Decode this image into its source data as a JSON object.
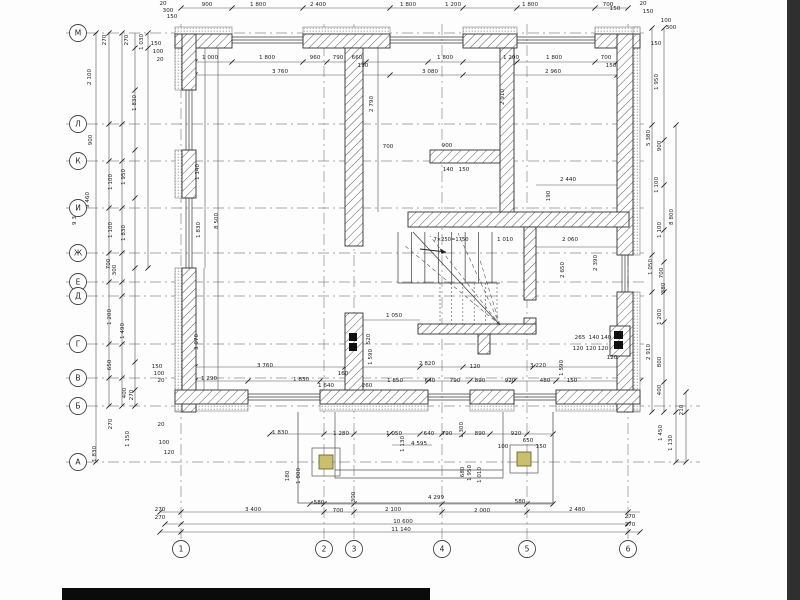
{
  "drawing_type": "architectural floor plan (GOST / Cyrillic axis grid)",
  "colors": {
    "paper": "#fdfdfd",
    "line": "#3a3a3a",
    "dim_line": "#555555",
    "axis_dash": "#8a8a8a",
    "hatch": "#5a5a5a",
    "insulation_dot": "#7a7a7a",
    "flue": "#101010",
    "porch_column_fill": "#c9bf6e",
    "porch_column_stroke": "#6f6a2e",
    "page_edge": "#2f2f2f",
    "bottom_bar": "#0b0b0b"
  },
  "axes": {
    "radius": 8.5,
    "letters_x": 78,
    "letters_line_x2": 648,
    "letters_line_x2_long": 700,
    "numbers_y": 549,
    "numbers_line_y1": 24,
    "numbers_line_y2": 543,
    "letters": [
      {
        "label": "М",
        "y": 33
      },
      {
        "label": "Л",
        "y": 124
      },
      {
        "label": "К",
        "y": 161
      },
      {
        "label": "И",
        "y": 208
      },
      {
        "label": "Ж",
        "y": 253
      },
      {
        "label": "Е",
        "y": 282
      },
      {
        "label": "Д",
        "y": 296
      },
      {
        "label": "Г",
        "y": 344
      },
      {
        "label": "В",
        "y": 378
      },
      {
        "label": "Б",
        "y": 406
      },
      {
        "label": "А",
        "y": 462
      }
    ],
    "numbers": [
      {
        "label": "1",
        "x": 181
      },
      {
        "label": "2",
        "x": 324
      },
      {
        "label": "3",
        "x": 354
      },
      {
        "label": "4",
        "x": 442
      },
      {
        "label": "5",
        "x": 527
      },
      {
        "label": "6",
        "x": 628
      }
    ]
  },
  "walls": {
    "outer_hatched": [
      [
        175,
        34,
        57,
        14
      ],
      [
        303,
        34,
        87,
        14
      ],
      [
        463,
        34,
        54,
        14
      ],
      [
        595,
        34,
        45,
        14
      ],
      [
        182,
        34,
        14,
        56
      ],
      [
        182,
        150,
        14,
        48
      ],
      [
        182,
        268,
        14,
        144
      ],
      [
        617,
        34,
        16,
        221
      ],
      [
        617,
        292,
        16,
        120
      ],
      [
        175,
        390,
        73,
        14
      ],
      [
        320,
        390,
        108,
        14
      ],
      [
        470,
        390,
        44,
        14
      ],
      [
        556,
        390,
        84,
        14
      ]
    ],
    "insulation_bands": [
      [
        175,
        27,
        57,
        7
      ],
      [
        303,
        27,
        87,
        7
      ],
      [
        463,
        27,
        54,
        7
      ],
      [
        595,
        27,
        45,
        7
      ],
      [
        175,
        34,
        7,
        56
      ],
      [
        175,
        150,
        7,
        48
      ],
      [
        175,
        268,
        7,
        144
      ],
      [
        633,
        27,
        7,
        228
      ],
      [
        633,
        292,
        7,
        120
      ],
      [
        175,
        404,
        73,
        7
      ],
      [
        320,
        404,
        108,
        7
      ],
      [
        470,
        404,
        44,
        7
      ],
      [
        556,
        404,
        84,
        7
      ]
    ],
    "interior_hatched": [
      [
        345,
        48,
        18,
        198
      ],
      [
        500,
        48,
        14,
        167
      ],
      [
        430,
        150,
        70,
        13
      ],
      [
        408,
        212,
        221,
        15
      ],
      [
        524,
        227,
        12,
        73
      ],
      [
        524,
        318,
        12,
        16
      ],
      [
        418,
        324,
        118,
        10
      ],
      [
        478,
        334,
        12,
        20
      ],
      [
        345,
        313,
        18,
        77
      ],
      [
        610,
        326,
        20,
        30
      ]
    ],
    "flues": [
      [
        349,
        333,
        8,
        8
      ],
      [
        349,
        343,
        8,
        8
      ],
      [
        614,
        331,
        9,
        8
      ],
      [
        614,
        341,
        9,
        8
      ]
    ]
  },
  "windows": {
    "horizontal": [
      {
        "x1": 232,
        "x2": 303,
        "y": 40
      },
      {
        "x1": 390,
        "x2": 463,
        "y": 40
      },
      {
        "x1": 517,
        "x2": 595,
        "y": 40
      },
      {
        "x1": 248,
        "x2": 320,
        "y": 397
      },
      {
        "x1": 428,
        "x2": 470,
        "y": 397
      },
      {
        "x1": 514,
        "x2": 556,
        "y": 397
      }
    ],
    "vertical": [
      {
        "y1": 90,
        "y2": 150,
        "x": 189
      },
      {
        "y1": 198,
        "y2": 268,
        "x": 189
      },
      {
        "y1": 255,
        "y2": 292,
        "x": 625
      }
    ]
  },
  "stair": {
    "label": "7×250=1750",
    "label_xy": [
      451,
      241
    ],
    "dir_label": "1 010",
    "flight": {
      "x1": 398,
      "x2": 492,
      "y1": 232,
      "y2": 283,
      "n": 8
    },
    "lower": {
      "x1": 440,
      "x2": 497,
      "y1": 283,
      "y2": 325,
      "n": 6
    },
    "center": [
      500,
      325
    ],
    "fan": [
      [
        404,
        245
      ],
      [
        430,
        236
      ],
      [
        458,
        233
      ],
      [
        480,
        260
      ]
    ],
    "diag": [
      413,
      232
    ],
    "arrow": {
      "x": 420,
      "y": 249,
      "len": 26
    }
  },
  "porch": {
    "outer": [
      298,
      412,
      255,
      91
    ],
    "inner": [
      335,
      412,
      168,
      66
    ],
    "extra_line_y": 470,
    "column_pads": [
      [
        312,
        448,
        28,
        28
      ],
      [
        510,
        445,
        28,
        28
      ]
    ],
    "columns": [
      [
        319,
        455,
        14,
        14
      ],
      [
        517,
        452,
        14,
        14
      ]
    ]
  },
  "dim_lines": [
    [
      181,
      8,
      628,
      8
    ],
    [
      195,
      62,
      617,
      62
    ],
    [
      195,
      75,
      617,
      75
    ],
    [
      96,
      33,
      96,
      462
    ],
    [
      109,
      33,
      109,
      406
    ],
    [
      122,
      33,
      122,
      406
    ],
    [
      135,
      33,
      135,
      406
    ],
    [
      148,
      33,
      148,
      268
    ],
    [
      652,
      28,
      652,
      412
    ],
    [
      664,
      28,
      664,
      412
    ],
    [
      676,
      125,
      676,
      462
    ],
    [
      686,
      392,
      686,
      462
    ],
    [
      195,
      367,
      620,
      367
    ],
    [
      195,
      381,
      640,
      381
    ],
    [
      270,
      434,
      553,
      434
    ],
    [
      310,
      504,
      553,
      504
    ],
    [
      160,
      512,
      640,
      512
    ],
    [
      165,
      524,
      628,
      524
    ],
    [
      160,
      532,
      640,
      532
    ],
    [
      218,
      48,
      218,
      390
    ],
    [
      205,
      48,
      205,
      268
    ],
    [
      204,
      268,
      204,
      390
    ],
    [
      378,
      48,
      378,
      212
    ],
    [
      510,
      48,
      510,
      212
    ],
    [
      536,
      247,
      629,
      247
    ],
    [
      536,
      185,
      617,
      185
    ],
    [
      363,
      320,
      420,
      320
    ],
    [
      392,
      445,
      432,
      445
    ]
  ],
  "tick_rows": [
    {
      "y": 8,
      "xs": [
        181,
        232,
        303,
        390,
        463,
        517,
        595,
        628
      ]
    },
    {
      "y": 62,
      "xs": [
        195,
        232,
        303,
        327,
        349,
        366,
        428,
        463,
        517,
        595,
        617
      ]
    },
    {
      "y": 75,
      "xs": [
        195,
        390,
        463,
        617
      ]
    },
    {
      "y": 367,
      "xs": [
        195,
        345,
        420,
        463,
        533,
        620
      ]
    },
    {
      "y": 381,
      "xs": [
        195,
        248,
        320,
        428,
        470,
        514,
        556,
        640
      ]
    },
    {
      "y": 434,
      "xs": [
        270,
        324,
        354,
        390,
        420,
        442,
        463,
        490,
        527,
        553
      ]
    },
    {
      "y": 504,
      "xs": [
        310,
        324,
        354,
        442,
        527,
        553
      ]
    },
    {
      "y": 512,
      "xs": [
        160,
        181,
        324,
        354,
        442,
        527,
        628
      ]
    },
    {
      "y": 524,
      "xs": [
        165,
        181,
        628
      ]
    },
    {
      "y": 532,
      "xs": [
        160,
        181,
        628,
        640
      ]
    }
  ],
  "tick_cols": [
    {
      "x": 96,
      "ys": [
        33,
        462
      ]
    },
    {
      "x": 109,
      "ys": [
        33,
        124,
        161,
        208,
        253,
        282,
        344,
        378,
        406
      ]
    },
    {
      "x": 122,
      "ys": [
        33,
        124,
        161,
        208,
        253,
        282,
        296,
        344,
        378,
        406
      ]
    },
    {
      "x": 135,
      "ys": [
        48,
        90,
        150,
        198,
        268,
        362,
        390,
        406
      ]
    },
    {
      "x": 148,
      "ys": [
        33,
        48,
        268
      ]
    },
    {
      "x": 652,
      "ys": [
        28,
        125,
        255,
        292,
        412
      ]
    },
    {
      "x": 664,
      "ys": [
        28,
        140,
        185,
        230,
        262,
        292,
        322,
        382,
        412
      ]
    },
    {
      "x": 676,
      "ys": [
        125,
        412,
        462
      ]
    },
    {
      "x": 686,
      "ys": [
        392,
        412,
        462
      ]
    }
  ],
  "dims": [
    [
      207,
      6,
      "900"
    ],
    [
      258,
      6,
      "1 800"
    ],
    [
      318,
      6,
      "2 400"
    ],
    [
      408,
      6,
      "1 800"
    ],
    [
      453,
      6,
      "1 200"
    ],
    [
      530,
      6,
      "1 800"
    ],
    [
      608,
      6,
      "700"
    ],
    [
      163,
      5,
      "20"
    ],
    [
      168,
      12,
      "300"
    ],
    [
      172,
      18,
      "150"
    ],
    [
      615,
      10,
      "150"
    ],
    [
      643,
      5,
      "20"
    ],
    [
      648,
      13,
      "150"
    ],
    [
      210,
      59,
      "1 000"
    ],
    [
      267,
      59,
      "1 800"
    ],
    [
      315,
      59,
      "960"
    ],
    [
      338,
      59,
      "790"
    ],
    [
      357,
      59,
      "660"
    ],
    [
      363,
      67,
      "190"
    ],
    [
      445,
      59,
      "1 800"
    ],
    [
      511,
      59,
      "1 200"
    ],
    [
      554,
      59,
      "1 800"
    ],
    [
      606,
      59,
      "700"
    ],
    [
      611,
      67,
      "150"
    ],
    [
      280,
      73,
      "3 760"
    ],
    [
      430,
      73,
      "3 080"
    ],
    [
      553,
      73,
      "2 960"
    ],
    [
      373,
      104,
      "2 790",
      1
    ],
    [
      504,
      97,
      "2 910",
      1
    ],
    [
      388,
      148,
      "700"
    ],
    [
      447,
      147,
      "900"
    ],
    [
      448,
      171,
      "140"
    ],
    [
      464,
      171,
      "150"
    ],
    [
      91,
      77,
      "2 100",
      1
    ],
    [
      106,
      40,
      "270",
      1
    ],
    [
      128,
      40,
      "270",
      1
    ],
    [
      143,
      42,
      "1 030",
      1
    ],
    [
      136,
      103,
      "1 830",
      1
    ],
    [
      156,
      45,
      "150"
    ],
    [
      158,
      53,
      "100"
    ],
    [
      160,
      61,
      "20"
    ],
    [
      92,
      140,
      "900",
      1
    ],
    [
      76,
      217,
      "9 345",
      1
    ],
    [
      89,
      200,
      "9 460",
      1
    ],
    [
      112,
      182,
      "1 100",
      1
    ],
    [
      125,
      177,
      "1 950",
      1
    ],
    [
      112,
      230,
      "1 100",
      1
    ],
    [
      125,
      233,
      "1 830",
      1
    ],
    [
      110,
      264,
      "700",
      1
    ],
    [
      116,
      270,
      "300",
      1
    ],
    [
      111,
      317,
      "1 200",
      1
    ],
    [
      124,
      331,
      "1 490",
      1
    ],
    [
      111,
      365,
      "650",
      1
    ],
    [
      126,
      393,
      "400",
      1
    ],
    [
      133,
      395,
      "270",
      1
    ],
    [
      112,
      424,
      "270",
      1
    ],
    [
      129,
      439,
      "1 150",
      1
    ],
    [
      96,
      454,
      "1 830",
      1
    ],
    [
      157,
      368,
      "150"
    ],
    [
      159,
      375,
      "100"
    ],
    [
      161,
      382,
      "20"
    ],
    [
      161,
      426,
      "20"
    ],
    [
      164,
      444,
      "100"
    ],
    [
      169,
      454,
      "120"
    ],
    [
      656,
      45,
      "150"
    ],
    [
      666,
      22,
      "100"
    ],
    [
      671,
      29,
      "300"
    ],
    [
      658,
      82,
      "1 950",
      1
    ],
    [
      650,
      138,
      "5 380",
      1
    ],
    [
      661,
      146,
      "900",
      1
    ],
    [
      658,
      185,
      "1 100",
      1
    ],
    [
      673,
      217,
      "8 800",
      1
    ],
    [
      661,
      230,
      "1 100",
      1
    ],
    [
      652,
      267,
      "1 050",
      1
    ],
    [
      663,
      273,
      "700",
      1
    ],
    [
      665,
      288,
      "380",
      1
    ],
    [
      661,
      317,
      "1 200",
      1
    ],
    [
      650,
      352,
      "2 910",
      1
    ],
    [
      661,
      362,
      "800",
      1
    ],
    [
      661,
      390,
      "400",
      1
    ],
    [
      683,
      410,
      "210",
      1
    ],
    [
      662,
      433,
      "1 450",
      1
    ],
    [
      672,
      443,
      "1 130",
      1
    ],
    [
      218,
      221,
      "8 500",
      1
    ],
    [
      199,
      172,
      "1 140",
      1
    ],
    [
      200,
      230,
      "1 830",
      1
    ],
    [
      198,
      342,
      "3 070",
      1
    ],
    [
      550,
      196,
      "190",
      1
    ],
    [
      568,
      181,
      "2 440"
    ],
    [
      570,
      241,
      "2 060"
    ],
    [
      564,
      270,
      "2 650",
      1
    ],
    [
      597,
      263,
      "2 390",
      1
    ],
    [
      505,
      241,
      "1 010"
    ],
    [
      394,
      317,
      "1 050"
    ],
    [
      370,
      339,
      "520",
      1
    ],
    [
      372,
      357,
      "1 590",
      1
    ],
    [
      265,
      367,
      "3 760"
    ],
    [
      427,
      365,
      "2 820"
    ],
    [
      538,
      367,
      "3 220"
    ],
    [
      475,
      368,
      "120"
    ],
    [
      563,
      368,
      "1 590",
      1
    ],
    [
      209,
      380,
      "1 290"
    ],
    [
      301,
      381,
      "1 830"
    ],
    [
      326,
      387,
      "1 640"
    ],
    [
      343,
      375,
      "160"
    ],
    [
      367,
      387,
      "260"
    ],
    [
      395,
      382,
      "1 850"
    ],
    [
      430,
      382,
      "640"
    ],
    [
      455,
      382,
      "790"
    ],
    [
      480,
      382,
      "890"
    ],
    [
      510,
      382,
      "920"
    ],
    [
      545,
      382,
      "480"
    ],
    [
      572,
      382,
      "150"
    ],
    [
      580,
      339,
      "265"
    ],
    [
      594,
      339,
      "140"
    ],
    [
      606,
      339,
      "140"
    ],
    [
      578,
      350,
      "120"
    ],
    [
      591,
      350,
      "120"
    ],
    [
      603,
      350,
      "120"
    ],
    [
      612,
      359,
      "120"
    ],
    [
      280,
      434,
      "1 830"
    ],
    [
      341,
      435,
      "1 280"
    ],
    [
      394,
      435,
      "1 050"
    ],
    [
      429,
      435,
      "640"
    ],
    [
      447,
      435,
      "790"
    ],
    [
      463,
      430,
      "1 300",
      1
    ],
    [
      480,
      435,
      "890"
    ],
    [
      516,
      435,
      "920"
    ],
    [
      528,
      442,
      "650"
    ],
    [
      541,
      448,
      "150"
    ],
    [
      503,
      448,
      "100"
    ],
    [
      419,
      445,
      "4 595"
    ],
    [
      404,
      444,
      "1 130",
      1
    ],
    [
      289,
      476,
      "180",
      1
    ],
    [
      300,
      476,
      "1 800",
      1
    ],
    [
      464,
      472,
      "680",
      1
    ],
    [
      471,
      473,
      "1 950",
      1
    ],
    [
      481,
      475,
      "1 010",
      1
    ],
    [
      355,
      497,
      "300",
      1
    ],
    [
      319,
      504,
      "580"
    ],
    [
      436,
      499,
      "4 299"
    ],
    [
      520,
      503,
      "580"
    ],
    [
      253,
      511,
      "3 400"
    ],
    [
      338,
      512,
      "700"
    ],
    [
      393,
      511,
      "2 100"
    ],
    [
      482,
      512,
      "2 000"
    ],
    [
      577,
      511,
      "2 480"
    ],
    [
      160,
      511,
      "270"
    ],
    [
      160,
      519,
      "270"
    ],
    [
      630,
      518,
      "270"
    ],
    [
      630,
      526,
      "270"
    ],
    [
      403,
      523,
      "10 600"
    ],
    [
      401,
      531,
      "11 140"
    ]
  ]
}
